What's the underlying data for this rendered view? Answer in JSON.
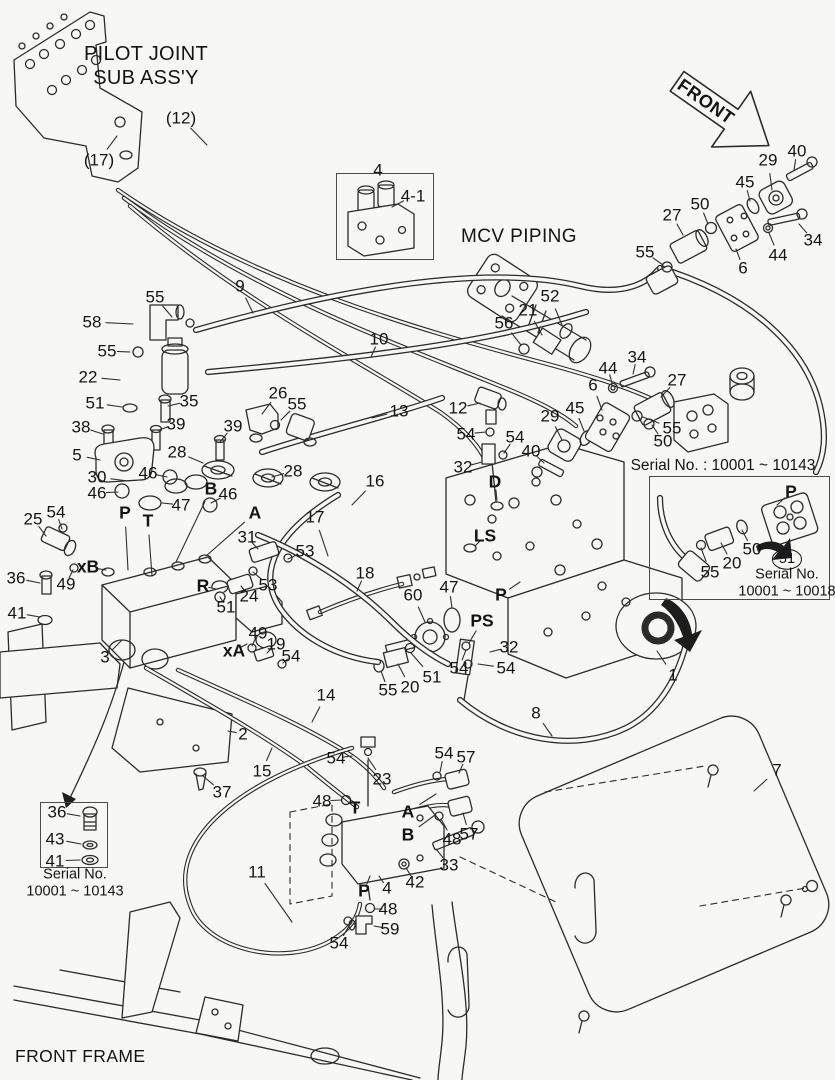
{
  "texts": {
    "pilot_joint_line1": "PILOT JOINT",
    "pilot_joint_line2": "SUB ASS'Y",
    "front": "FRONT",
    "mcv_piping": "MCV PIPING",
    "front_frame": "FRONT FRAME",
    "inset_right": {
      "title": "Serial No. : 10001 ~ 10143",
      "serial_line1": "Serial No.",
      "serial_line2": "10001 ~ 10018"
    },
    "inset_left": {
      "caption_line1": "Serial No.",
      "caption_line2": "10001 ~ 10143"
    }
  },
  "colors": {
    "background": "#f7f7f4",
    "line": "#2b2b2b"
  },
  "callouts": [
    {
      "t": "(12)",
      "x": 181,
      "y": 118,
      "lx": 207,
      "ly": 145
    },
    {
      "t": "(17)",
      "x": 99,
      "y": 160,
      "lx": 117,
      "ly": 136
    },
    {
      "t": "4",
      "x": 378,
      "y": 170
    },
    {
      "t": "4-1",
      "x": 413,
      "y": 196,
      "lx": 392,
      "ly": 207
    },
    {
      "t": "9",
      "x": 240,
      "y": 286,
      "lx": 253,
      "ly": 313
    },
    {
      "t": "55",
      "x": 155,
      "y": 297,
      "lx": 172,
      "ly": 317
    },
    {
      "t": "58",
      "x": 92,
      "y": 322,
      "lx": 133,
      "ly": 324
    },
    {
      "t": "55",
      "x": 107,
      "y": 351,
      "lx": 130,
      "ly": 352
    },
    {
      "t": "22",
      "x": 88,
      "y": 377,
      "lx": 120,
      "ly": 380
    },
    {
      "t": "10",
      "x": 379,
      "y": 339,
      "lx": 371,
      "ly": 357
    },
    {
      "t": "51",
      "x": 95,
      "y": 403,
      "lx": 122,
      "ly": 407
    },
    {
      "t": "35",
      "x": 189,
      "y": 401,
      "lx": 168,
      "ly": 406
    },
    {
      "t": "13",
      "x": 399,
      "y": 411,
      "lx": 372,
      "ly": 418
    },
    {
      "t": "38",
      "x": 81,
      "y": 427,
      "lx": 103,
      "ly": 434
    },
    {
      "t": "39",
      "x": 176,
      "y": 424,
      "lx": 159,
      "ly": 430
    },
    {
      "t": "39",
      "x": 233,
      "y": 426,
      "lx": 220,
      "ly": 442
    },
    {
      "t": "26",
      "x": 278,
      "y": 393,
      "lx": 262,
      "ly": 414
    },
    {
      "t": "55",
      "x": 297,
      "y": 404,
      "lx": 281,
      "ly": 420
    },
    {
      "t": "5",
      "x": 77,
      "y": 455,
      "lx": 100,
      "ly": 460
    },
    {
      "t": "28",
      "x": 177,
      "y": 452,
      "lx": 203,
      "ly": 463
    },
    {
      "t": "30",
      "x": 97,
      "y": 477,
      "lx": 128,
      "ly": 481
    },
    {
      "t": "46",
      "x": 148,
      "y": 473,
      "lx": 167,
      "ly": 477
    },
    {
      "t": "B",
      "x": 211,
      "y": 489,
      "b": 1,
      "lx": 176,
      "ly": 562
    },
    {
      "t": "46",
      "x": 228,
      "y": 494,
      "lx": 211,
      "ly": 503
    },
    {
      "t": "28",
      "x": 293,
      "y": 471,
      "lx": 272,
      "ly": 477
    },
    {
      "t": "46",
      "x": 97,
      "y": 493,
      "lx": 118,
      "ly": 492
    },
    {
      "t": "P",
      "x": 125,
      "y": 513,
      "b": 1,
      "lx": 128,
      "ly": 570
    },
    {
      "t": "T",
      "x": 148,
      "y": 521,
      "b": 1,
      "lx": 152,
      "ly": 576
    },
    {
      "t": "47",
      "x": 181,
      "y": 505,
      "lx": 162,
      "ly": 503
    },
    {
      "t": "A",
      "x": 255,
      "y": 513,
      "b": 1,
      "lx": 206,
      "ly": 556
    },
    {
      "t": "16",
      "x": 375,
      "y": 481,
      "lx": 352,
      "ly": 505
    },
    {
      "t": "17",
      "x": 315,
      "y": 517,
      "lx": 328,
      "ly": 556
    },
    {
      "t": "25",
      "x": 33,
      "y": 519,
      "lx": 46,
      "ly": 536
    },
    {
      "t": "54",
      "x": 56,
      "y": 512,
      "lx": 62,
      "ly": 529
    },
    {
      "t": "31",
      "x": 247,
      "y": 537,
      "lx": 258,
      "ly": 549
    },
    {
      "t": "53",
      "x": 305,
      "y": 551,
      "lx": 288,
      "ly": 559
    },
    {
      "t": "xB",
      "x": 88,
      "y": 567,
      "b": 1,
      "lx": 106,
      "ly": 570
    },
    {
      "t": "49",
      "x": 66,
      "y": 584,
      "lx": 73,
      "ly": 570
    },
    {
      "t": "53",
      "x": 268,
      "y": 585,
      "lx": 253,
      "ly": 572
    },
    {
      "t": "R",
      "x": 203,
      "y": 586,
      "b": 1,
      "lx": 216,
      "ly": 589
    },
    {
      "t": "24",
      "x": 249,
      "y": 596,
      "lx": 241,
      "ly": 586
    },
    {
      "t": "51",
      "x": 226,
      "y": 607,
      "lx": 220,
      "ly": 597
    },
    {
      "t": "36",
      "x": 16,
      "y": 578,
      "lx": 40,
      "ly": 583
    },
    {
      "t": "41",
      "x": 17,
      "y": 613,
      "lx": 40,
      "ly": 617
    },
    {
      "t": "18",
      "x": 365,
      "y": 573,
      "lx": 357,
      "ly": 591
    },
    {
      "t": "60",
      "x": 413,
      "y": 595,
      "lx": 425,
      "ly": 622
    },
    {
      "t": "47",
      "x": 449,
      "y": 587,
      "lx": 452,
      "ly": 608
    },
    {
      "t": "P",
      "x": 501,
      "y": 595,
      "b": 1,
      "lx": 520,
      "ly": 582
    },
    {
      "t": "PS",
      "x": 482,
      "y": 621,
      "b": 1,
      "lx": 469,
      "ly": 643
    },
    {
      "t": "3",
      "x": 105,
      "y": 657,
      "lx": 122,
      "ly": 640
    },
    {
      "t": "xA",
      "x": 234,
      "y": 651,
      "b": 1,
      "lx": 247,
      "ly": 644
    },
    {
      "t": "49",
      "x": 258,
      "y": 633,
      "lx": 252,
      "ly": 646
    },
    {
      "t": "19",
      "x": 276,
      "y": 644,
      "lx": 267,
      "ly": 653
    },
    {
      "t": "54",
      "x": 291,
      "y": 656,
      "lx": 283,
      "ly": 663
    },
    {
      "t": "32",
      "x": 509,
      "y": 647,
      "lx": 490,
      "ly": 652
    },
    {
      "t": "54",
      "x": 459,
      "y": 668,
      "lx": 466,
      "ly": 650
    },
    {
      "t": "54",
      "x": 506,
      "y": 668,
      "lx": 478,
      "ly": 664
    },
    {
      "t": "55",
      "x": 388,
      "y": 690,
      "lx": 381,
      "ly": 671
    },
    {
      "t": "20",
      "x": 410,
      "y": 687,
      "lx": 398,
      "ly": 664
    },
    {
      "t": "51",
      "x": 432,
      "y": 677,
      "lx": 411,
      "ly": 653
    },
    {
      "t": "8",
      "x": 536,
      "y": 713,
      "lx": 552,
      "ly": 736
    },
    {
      "t": "12",
      "x": 458,
      "y": 408,
      "lx": 480,
      "ly": 403
    },
    {
      "t": "54",
      "x": 466,
      "y": 434,
      "lx": 486,
      "ly": 432
    },
    {
      "t": "54",
      "x": 515,
      "y": 437,
      "lx": 504,
      "ly": 453
    },
    {
      "t": "32",
      "x": 463,
      "y": 467,
      "lx": 482,
      "ly": 462
    },
    {
      "t": "D",
      "x": 495,
      "y": 482,
      "b": 1,
      "lx": 497,
      "ly": 500
    },
    {
      "t": "40",
      "x": 531,
      "y": 451,
      "lx": 544,
      "ly": 463
    },
    {
      "t": "29",
      "x": 550,
      "y": 416,
      "lx": 562,
      "ly": 440
    },
    {
      "t": "45",
      "x": 575,
      "y": 408,
      "lx": 584,
      "ly": 431
    },
    {
      "t": "6",
      "x": 593,
      "y": 385,
      "lx": 602,
      "ly": 410
    },
    {
      "t": "44",
      "x": 608,
      "y": 368,
      "lx": 612,
      "ly": 383
    },
    {
      "t": "34",
      "x": 637,
      "y": 357,
      "lx": 633,
      "ly": 374
    },
    {
      "t": "27",
      "x": 677,
      "y": 380,
      "lx": 661,
      "ly": 397
    },
    {
      "t": "55",
      "x": 672,
      "y": 428,
      "lx": 643,
      "ly": 417
    },
    {
      "t": "50",
      "x": 663,
      "y": 441,
      "lx": 652,
      "ly": 425
    },
    {
      "t": "LS",
      "x": 485,
      "y": 536,
      "b": 1,
      "lx": 475,
      "ly": 546
    },
    {
      "t": "52",
      "x": 550,
      "y": 296,
      "lx": 562,
      "ly": 325
    },
    {
      "t": "21",
      "x": 528,
      "y": 310,
      "lx": 542,
      "ly": 335
    },
    {
      "t": "56",
      "x": 504,
      "y": 323,
      "lx": 521,
      "ly": 345
    },
    {
      "t": "55",
      "x": 645,
      "y": 252,
      "lx": 663,
      "ly": 265
    },
    {
      "t": "27",
      "x": 672,
      "y": 215,
      "lx": 683,
      "ly": 235
    },
    {
      "t": "50",
      "x": 700,
      "y": 204,
      "lx": 708,
      "ly": 224
    },
    {
      "t": "45",
      "x": 745,
      "y": 182,
      "lx": 750,
      "ly": 201
    },
    {
      "t": "29",
      "x": 768,
      "y": 160,
      "lx": 772,
      "ly": 190
    },
    {
      "t": "40",
      "x": 797,
      "y": 151,
      "lx": 794,
      "ly": 170
    },
    {
      "t": "6",
      "x": 743,
      "y": 268,
      "lx": 736,
      "ly": 249
    },
    {
      "t": "44",
      "x": 778,
      "y": 255,
      "lx": 769,
      "ly": 233
    },
    {
      "t": "34",
      "x": 813,
      "y": 240,
      "lx": 799,
      "ly": 224
    },
    {
      "t": "1",
      "x": 673,
      "y": 675,
      "lx": 657,
      "ly": 651
    },
    {
      "t": "7",
      "x": 777,
      "y": 770,
      "lx": 754,
      "ly": 791
    },
    {
      "t": "14",
      "x": 326,
      "y": 695,
      "lx": 312,
      "ly": 722
    },
    {
      "t": "2",
      "x": 243,
      "y": 734,
      "lx": 228,
      "ly": 731
    },
    {
      "t": "15",
      "x": 262,
      "y": 771,
      "lx": 272,
      "ly": 748
    },
    {
      "t": "54",
      "x": 336,
      "y": 758,
      "lx": 352,
      "ly": 756
    },
    {
      "t": "23",
      "x": 382,
      "y": 779,
      "lx": 368,
      "ly": 758
    },
    {
      "t": "48",
      "x": 322,
      "y": 801,
      "lx": 342,
      "ly": 800
    },
    {
      "t": "T",
      "x": 355,
      "y": 808,
      "b": 1
    },
    {
      "t": "A",
      "x": 408,
      "y": 812,
      "b": 1,
      "lx": 436,
      "ly": 794
    },
    {
      "t": "B",
      "x": 408,
      "y": 835,
      "b": 1,
      "lx": 435,
      "ly": 815
    },
    {
      "t": "54",
      "x": 444,
      "y": 753,
      "lx": 440,
      "ly": 772
    },
    {
      "t": "57",
      "x": 466,
      "y": 757,
      "lx": 459,
      "ly": 773
    },
    {
      "t": "48",
      "x": 452,
      "y": 839,
      "lx": 441,
      "ly": 819
    },
    {
      "t": "57",
      "x": 469,
      "y": 834,
      "lx": 463,
      "ly": 813
    },
    {
      "t": "33",
      "x": 449,
      "y": 865,
      "lx": 436,
      "ly": 849
    },
    {
      "t": "11",
      "x": 257,
      "y": 872,
      "lx": 292,
      "ly": 922
    },
    {
      "t": "P",
      "x": 364,
      "y": 891,
      "b": 1,
      "lx": 370,
      "ly": 876
    },
    {
      "t": "4",
      "x": 387,
      "y": 888,
      "lx": 379,
      "ly": 876
    },
    {
      "t": "42",
      "x": 415,
      "y": 882,
      "lx": 406,
      "ly": 868
    },
    {
      "t": "48",
      "x": 388,
      "y": 909,
      "lx": 375,
      "ly": 909
    },
    {
      "t": "59",
      "x": 390,
      "y": 929,
      "lx": 374,
      "ly": 926
    },
    {
      "t": "54",
      "x": 339,
      "y": 943,
      "lx": 349,
      "ly": 926
    },
    {
      "t": "36",
      "x": 57,
      "y": 812,
      "lx": 80,
      "ly": 816
    },
    {
      "t": "43",
      "x": 55,
      "y": 839,
      "lx": 81,
      "ly": 844
    },
    {
      "t": "41",
      "x": 55,
      "y": 861,
      "lx": 80,
      "ly": 860
    },
    {
      "t": "37",
      "x": 222,
      "y": 792,
      "lx": 203,
      "ly": 776
    },
    {
      "t": "P",
      "x": 791,
      "y": 492,
      "b": 1,
      "lx": 777,
      "ly": 505
    },
    {
      "t": "50",
      "x": 752,
      "y": 549,
      "lx": 742,
      "ly": 530
    },
    {
      "t": "20",
      "x": 732,
      "y": 563,
      "lx": 721,
      "ly": 543
    },
    {
      "t": "55",
      "x": 710,
      "y": 572,
      "lx": 701,
      "ly": 548
    },
    {
      "t": "51",
      "x": 787,
      "y": 559,
      "c": 1
    }
  ]
}
